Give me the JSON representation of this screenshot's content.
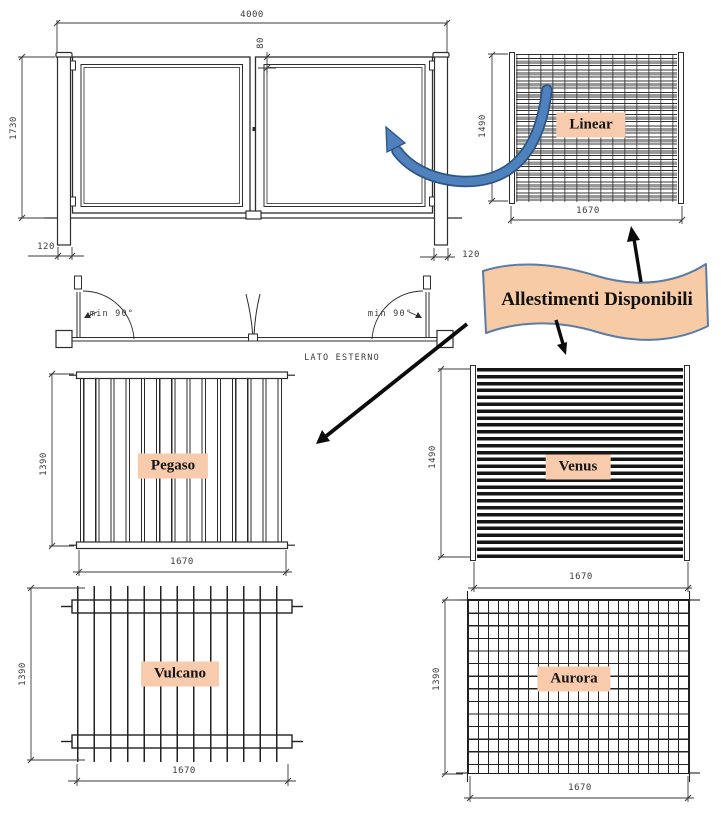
{
  "banner": {
    "label": "Allestimenti Disponibili"
  },
  "gate_front": {
    "dim_width": "4000",
    "dim_height": "1730",
    "dim_gap": "80",
    "dim_post_left": "120",
    "dim_post_right": "120"
  },
  "gate_plan": {
    "angle_left": "min 90°",
    "angle_right": "min 90°",
    "side_label": "LATO ESTERNO"
  },
  "panels": {
    "linear": {
      "name": "Linear",
      "dim_height": "1490",
      "dim_width": "1670"
    },
    "pegaso": {
      "name": "Pegaso",
      "dim_height": "1390",
      "dim_width": "1670"
    },
    "venus": {
      "name": "Venus",
      "dim_height": "1490",
      "dim_width": "1670"
    },
    "vulcano": {
      "name": "Vulcano",
      "dim_height": "1390",
      "dim_width": "1670"
    },
    "aurora": {
      "name": "Aurora",
      "dim_height": "1390",
      "dim_width": "1670"
    }
  },
  "colors": {
    "label_background": "#f8cbad",
    "banner_background": "#f7cba6",
    "banner_border": "#5b7ca6",
    "curve_arrow_blue": "#4f81bd",
    "drawing_line": "#2d2d2d"
  }
}
